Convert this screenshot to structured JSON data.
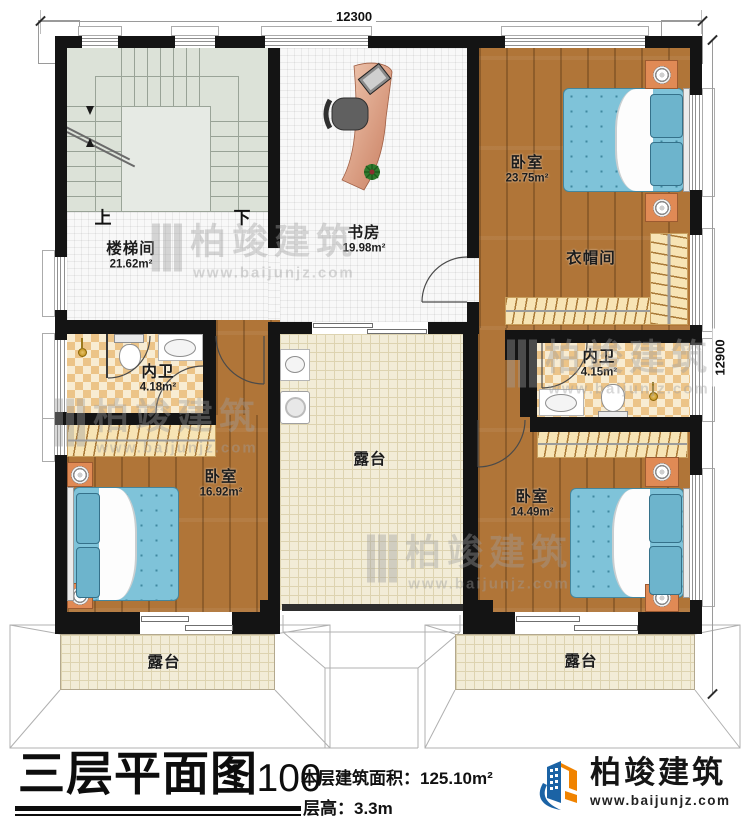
{
  "plan": {
    "dimensions": {
      "top": "12300",
      "right": "12900"
    },
    "rooms": [
      {
        "id": "stairwell",
        "label": "楼梯间",
        "area": "21.62m²"
      },
      {
        "id": "study",
        "label": "书房",
        "area": "19.98m²"
      },
      {
        "id": "bedroom-master",
        "label": "卧室",
        "area": "23.75m²"
      },
      {
        "id": "cloakroom",
        "label": "衣帽间",
        "area": ""
      },
      {
        "id": "bath-left",
        "label": "内卫",
        "area": "4.18m²"
      },
      {
        "id": "bath-right",
        "label": "内卫",
        "area": "4.15m²"
      },
      {
        "id": "bedroom-left",
        "label": "卧室",
        "area": "16.92m²"
      },
      {
        "id": "bedroom-right",
        "label": "卧室",
        "area": "14.49m²"
      },
      {
        "id": "terrace-middle",
        "label": "露台",
        "area": ""
      },
      {
        "id": "terrace-left",
        "label": "露台",
        "area": ""
      },
      {
        "id": "terrace-right",
        "label": "露台",
        "area": ""
      }
    ],
    "stair_labels": {
      "up": "上",
      "down": "下"
    }
  },
  "title_block": {
    "title": "三层平面图",
    "scale": "1:100",
    "area_label": "本层建筑面积：",
    "area_value": "125.10m²",
    "height_label": "层高：",
    "height_value": "3.3m"
  },
  "logo": {
    "name": "柏竣建筑",
    "url": "www.baijunjz.com"
  },
  "watermark": {
    "name": "柏竣建筑",
    "url": "www.baijunjz.com"
  },
  "colors": {
    "wall": "#141414",
    "wood": "#b07538",
    "bed": "#7fc3d9",
    "bedDot": "#3f88a0",
    "pillow": "#6db4cc",
    "checkerA": "#ecc488",
    "checkerB": "#f8ecd2",
    "cream": "#f2ecd7",
    "creamLine": "#ddd3b0",
    "stair": "#dce2d8",
    "nightstand": "#e08a55",
    "logoBlue": "#1b63a5",
    "logoOrange": "#f08300"
  }
}
